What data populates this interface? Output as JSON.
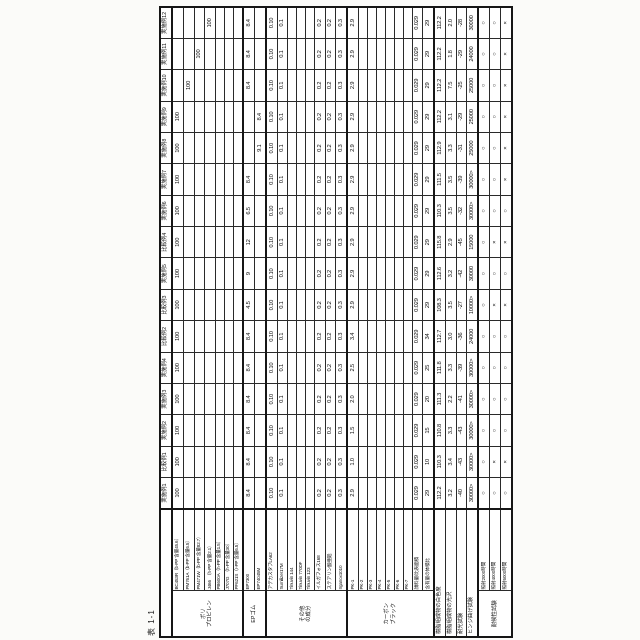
{
  "page": {
    "title": "表 1-1"
  },
  "table": {
    "columns": [
      "実施例1",
      "比較例1",
      "実施例2",
      "実施例3",
      "実施例4",
      "比較例2",
      "比較例3",
      "実施例5",
      "比較例4",
      "実施例6",
      "実施例7",
      "実施例8",
      "実施例9",
      "実施例10",
      "実施例11",
      "実施例12"
    ],
    "sections": [
      {
        "group": "ポリ\nプロピレン",
        "rows": [
          {
            "label": "BC453R（b-PP 含量45.6）",
            "values": [
              "100",
              "100",
              "100",
              "100",
              "100",
              "100",
              "100",
              "100",
              "100",
              "100",
              "100",
              "100",
              "100",
              "",
              "",
              ""
            ]
          },
          {
            "label": "PM761A（b-PP 含量6.5）",
            "values": [
              "",
              "",
              "",
              "",
              "",
              "",
              "",
              "",
              "",
              "",
              "",
              "",
              "",
              "100",
              "",
              ""
            ]
          },
          {
            "label": "PM471W（b-PP 含量82.7）",
            "values": [
              "",
              "",
              "",
              "",
              "",
              "",
              "",
              "",
              "",
              "",
              "",
              "",
              "",
              "",
              "100",
              ""
            ]
          },
          {
            "label": "J466　（h-PP 含量2.1）",
            "values": [
              "",
              "",
              "",
              "",
              "",
              "",
              "",
              "",
              "",
              "",
              "",
              "",
              "",
              "",
              "",
              "100"
            ]
          },
          {
            "label": "PB600A（h-PP 含量1.5）",
            "values": [
              "",
              "",
              "",
              "",
              "",
              "",
              "",
              "",
              "",
              "",
              "",
              "",
              "",
              "",
              "",
              ""
            ]
          },
          {
            "label": "J707G　（h-PP 含量30）",
            "values": [
              "",
              "",
              "",
              "",
              "",
              "",
              "",
              "",
              "",
              "",
              "",
              "",
              "",
              "",
              "",
              ""
            ]
          },
          {
            "label": "PF621S（r-PP 含量6.5）",
            "values": [
              "",
              "",
              "",
              "",
              "",
              "",
              "",
              "",
              "",
              "",
              "",
              "",
              "",
              "",
              "",
              ""
            ]
          }
        ]
      },
      {
        "group": "EPゴム",
        "rows": [
          {
            "label": "EP7300",
            "values": [
              "8.4",
              "8.4",
              "8.4",
              "8.4",
              "8.4",
              "8.4",
              "4.5",
              "9",
              "12",
              "6.5",
              "8.4",
              "",
              "",
              "8.4",
              "8.4",
              "8.4"
            ]
          },
          {
            "label": "EP74045M",
            "values": [
              "",
              "",
              "",
              "",
              "",
              "",
              "",
              "",
              "",
              "",
              "",
              "9.1",
              "8.4",
              "",
              "",
              ""
            ]
          }
        ]
      },
      {
        "group": "その他\nの成分",
        "rows": [
          {
            "label": "アデカスタブLA62",
            "values": [
              "0.10",
              "0.10",
              "0.10",
              "0.10",
              "0.10",
              "0.10",
              "0.10",
              "0.10",
              "0.10",
              "0.10",
              "0.10",
              "0.10",
              "0.10",
              "0.10",
              "0.10",
              "0.10"
            ]
          },
          {
            "label": "Sumilizer17M",
            "values": [
              "0.1",
              "0.1",
              "0.1",
              "0.1",
              "0.1",
              "0.1",
              "0.1",
              "0.1",
              "0.1",
              "0.1",
              "0.1",
              "0.1",
              "0.1",
              "0.1",
              "0.1",
              "0.1"
            ]
          },
          {
            "label": "Tinuvin 144",
            "values": [
              "",
              "",
              "",
              "",
              "",
              "",
              "",
              "",
              "",
              "",
              "",
              "",
              "",
              "",
              "",
              ""
            ]
          },
          {
            "label": "Tinuvin 770DF",
            "values": [
              "",
              "",
              "",
              "",
              "",
              "",
              "",
              "",
              "",
              "",
              "",
              "",
              "",
              "",
              "",
              ""
            ]
          },
          {
            "label": "Tinuvin 123",
            "values": [
              "",
              "",
              "",
              "",
              "",
              "",
              "",
              "",
              "",
              "",
              "",
              "",
              "",
              "",
              "",
              ""
            ]
          },
          {
            "label": "イルガフォス168",
            "values": [
              "0.2",
              "0.2",
              "0.2",
              "0.2",
              "0.2",
              "0.2",
              "0.2",
              "0.2",
              "0.2",
              "0.2",
              "0.2",
              "0.2",
              "0.2",
              "0.2",
              "0.2",
              "0.2"
            ]
          },
          {
            "label": "ステアリン酸亜鉛",
            "values": [
              "0.2",
              "0.2",
              "0.2",
              "0.2",
              "0.2",
              "0.2",
              "0.2",
              "0.2",
              "0.2",
              "0.2",
              "0.2",
              "0.2",
              "0.2",
              "0.2",
              "0.2",
              "0.2"
            ]
          },
          {
            "label": "Irganox1010",
            "values": [
              "0.3",
              "0.3",
              "0.3",
              "0.3",
              "0.3",
              "0.3",
              "0.3",
              "0.3",
              "0.3",
              "0.3",
              "0.3",
              "0.3",
              "0.3",
              "0.3",
              "0.3",
              "0.3"
            ]
          }
        ]
      },
      {
        "group": "カーボン\nブラック",
        "rows": [
          {
            "label": "PK-1",
            "values": [
              "2.9",
              "1.0",
              "1.5",
              "2.0",
              "2.5",
              "3.4",
              "2.9",
              "2.9",
              "2.9",
              "2.9",
              "2.9",
              "2.9",
              "2.9",
              "2.9",
              "2.9",
              "2.9"
            ]
          },
          {
            "label": "PK-2",
            "values": [
              "",
              "",
              "",
              "",
              "",
              "",
              "",
              "",
              "",
              "",
              "",
              "",
              "",
              "",
              "",
              ""
            ]
          },
          {
            "label": "PK-3",
            "values": [
              "",
              "",
              "",
              "",
              "",
              "",
              "",
              "",
              "",
              "",
              "",
              "",
              "",
              "",
              "",
              ""
            ]
          },
          {
            "label": "PK-4",
            "values": [
              "",
              "",
              "",
              "",
              "",
              "",
              "",
              "",
              "",
              "",
              "",
              "",
              "",
              "",
              "",
              ""
            ]
          },
          {
            "label": "PK-5",
            "values": [
              "",
              "",
              "",
              "",
              "",
              "",
              "",
              "",
              "",
              "",
              "",
              "",
              "",
              "",
              "",
              ""
            ]
          },
          {
            "label": "PK-6",
            "values": [
              "",
              "",
              "",
              "",
              "",
              "",
              "",
              "",
              "",
              "",
              "",
              "",
              "",
              "",
              "",
              ""
            ]
          },
          {
            "label": "PK-7",
            "values": [
              "",
              "",
              "",
              "",
              "",
              "",
              "",
              "",
              "",
              "",
              "",
              "",
              "",
              "",
              "",
              ""
            ]
          },
          {
            "label": "顔料量/比表面積",
            "values": [
              "0.029",
              "0.029",
              "0.029",
              "0.029",
              "0.029",
              "0.029",
              "0.029",
              "0.029",
              "0.029",
              "0.029",
              "0.029",
              "0.029",
              "0.029",
              "0.029",
              "0.029",
              "0.029"
            ]
          },
          {
            "label": "含有量の体積比",
            "values": [
              "29",
              "10",
              "15",
              "20",
              "25",
              "34",
              "29",
              "29",
              "29",
              "29",
              "29",
              "29",
              "29",
              "29",
              "29",
              "29"
            ]
          }
        ]
      },
      {
        "group": null,
        "span": true,
        "rows": [
          {
            "label": "樹脂組成物の白色度",
            "values": [
              "112.2",
              "110.3",
              "110.8",
              "111.3",
              "111.8",
              "112.7",
              "108.3",
              "112.6",
              "115.8",
              "110.3",
              "111.5",
              "112.9",
              "112.2",
              "112.2",
              "112.2",
              "112.2"
            ]
          },
          {
            "label": "樹脂組成物の光沢",
            "values": [
              "3.2",
              "3.4",
              "3.3",
              "2.2",
              "3.3",
              "3.0",
              "3.5",
              "3.2",
              "2.9",
              "3.5",
              "3.5",
              "3.3",
              "3.1",
              "7.5",
              "1.8",
              "2.0"
            ]
          },
          {
            "label": "耐光試験",
            "values": [
              "-40",
              "-43",
              "-43",
              "-41",
              "-39",
              "-36",
              "-27",
              "-42",
              "-45",
              "-32",
              "-39",
              "-31",
              "-29",
              "-25",
              "-29",
              "-28"
            ]
          },
          {
            "label": "ヒンジ曲げ試験",
            "values": [
              "30000>",
              "30000>",
              "30000>",
              "30000>",
              "30000>",
              "24000",
              "10000>",
              "30000",
              "15000",
              "30000>",
              "30000>",
              "25000",
              "25000",
              "25000",
              "24000",
              "30000"
            ]
          }
        ]
      },
      {
        "group": "耐候性試験",
        "rows": [
          {
            "label": "照射2000時間",
            "values": [
              "○",
              "○",
              "○",
              "○",
              "○",
              "○",
              "○",
              "○",
              "○",
              "○",
              "○",
              "○",
              "○",
              "○",
              "○",
              "○"
            ]
          },
          {
            "label": "照射4000時間",
            "values": [
              "○",
              "×",
              "○",
              "○",
              "○",
              "○",
              "×",
              "○",
              "×",
              "○",
              "○",
              "○",
              "○",
              "○",
              "○",
              "○"
            ]
          },
          {
            "label": "照射6000時間",
            "values": [
              "○",
              "×",
              "○",
              "○",
              "○",
              "○",
              "×",
              "○",
              "×",
              "○",
              "×",
              "×",
              "×",
              "×",
              "×",
              "×"
            ]
          }
        ]
      }
    ]
  }
}
